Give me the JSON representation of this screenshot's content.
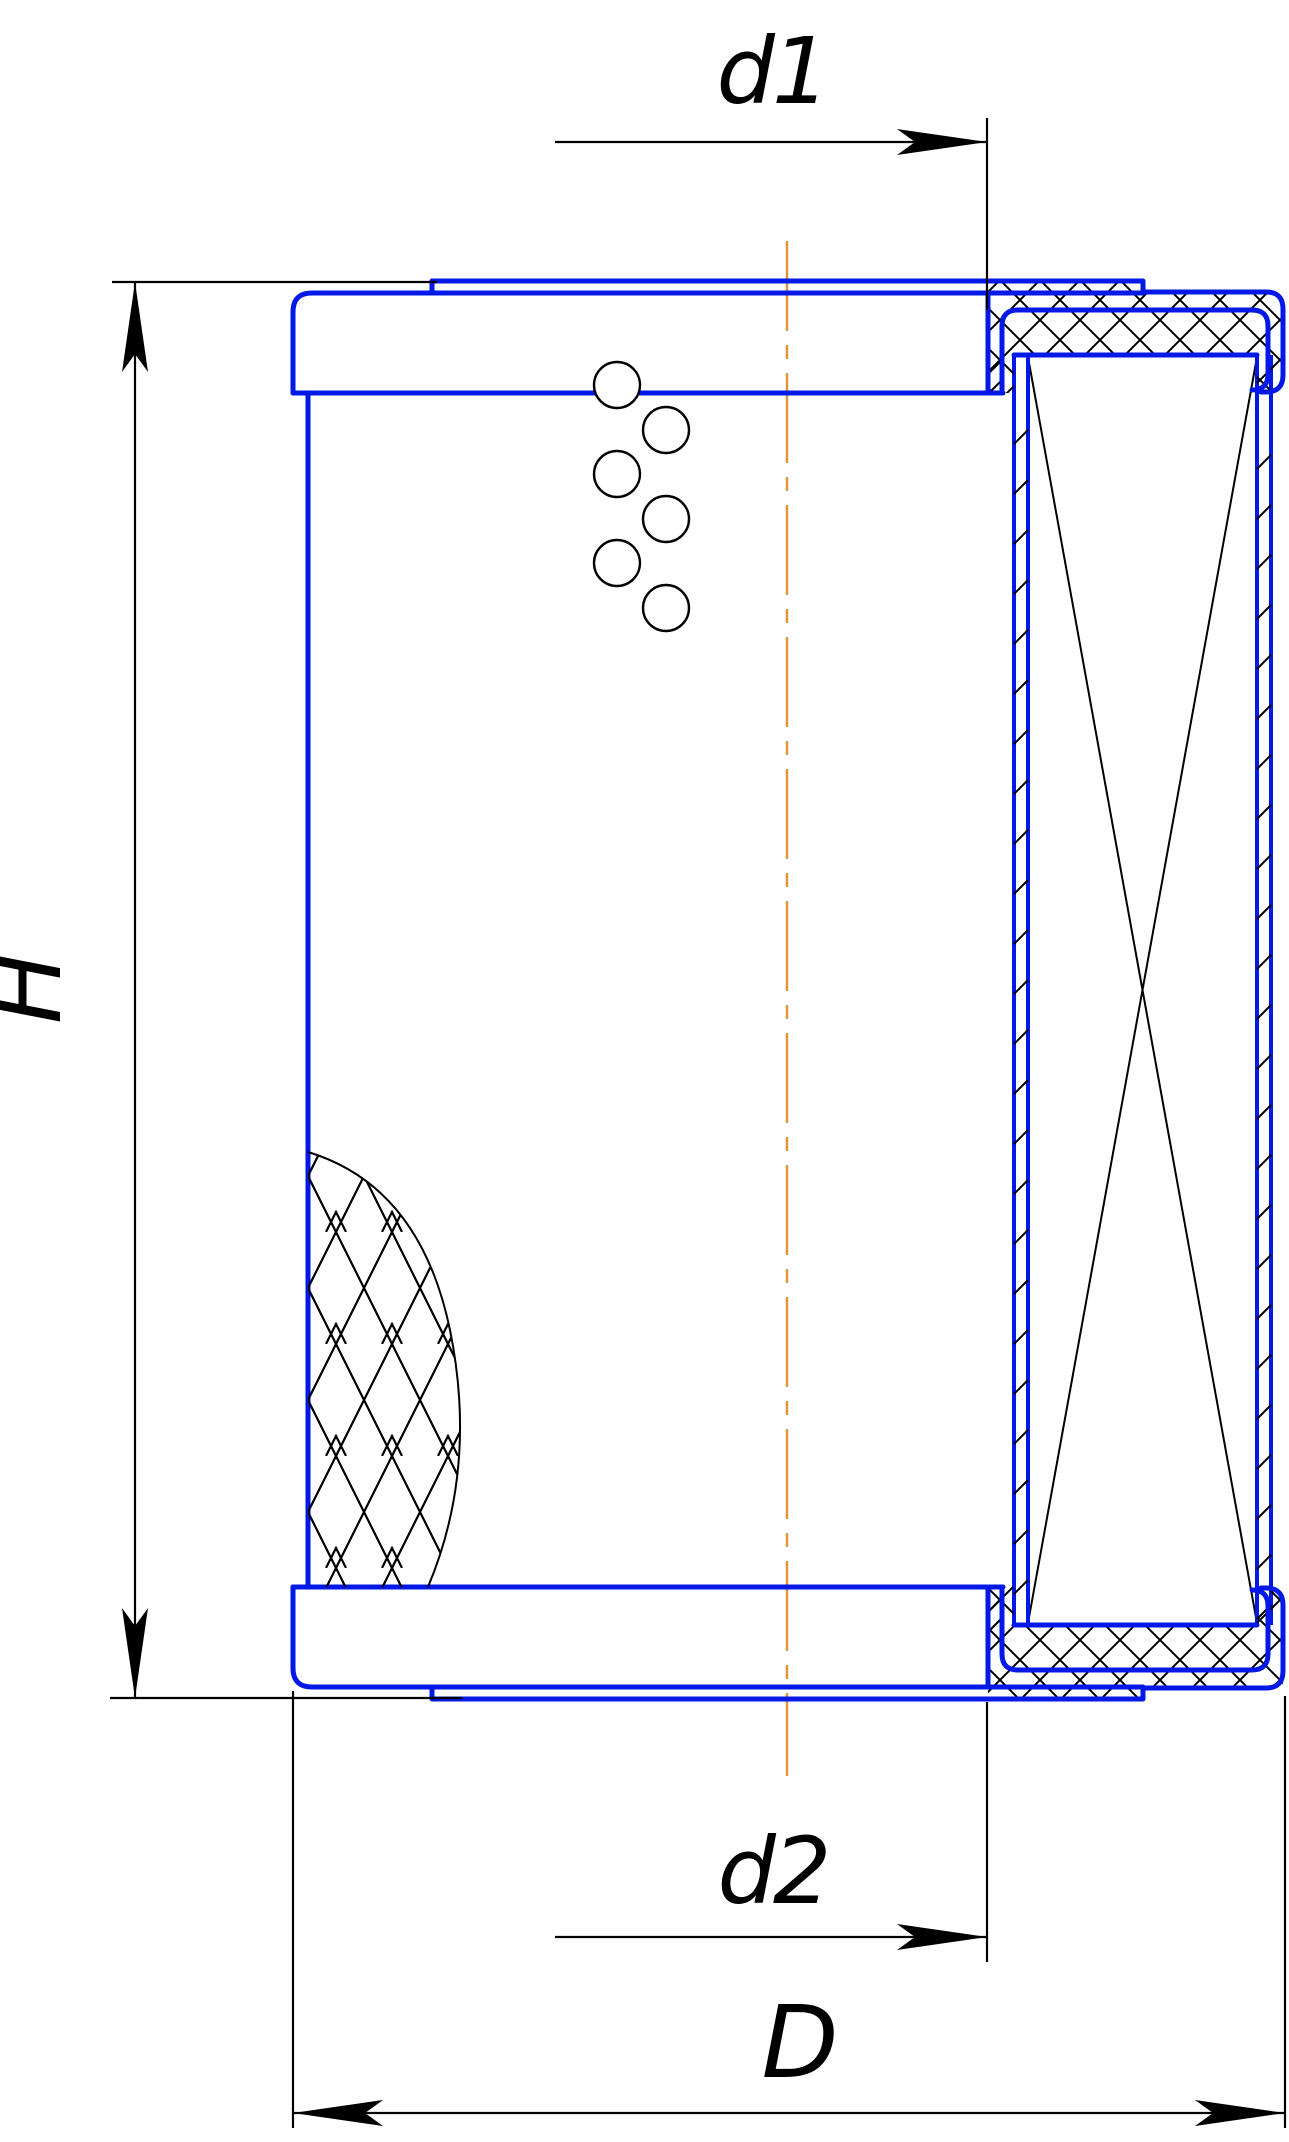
{
  "page": {
    "background": "#ffffff"
  },
  "colors": {
    "line-blue": "#0019e6",
    "centerline-orange": "#e0953c",
    "dimension-black": "#000000",
    "page-bg": "#ffffff"
  },
  "dimensions": [
    {
      "id": "d1",
      "label": "d1"
    },
    {
      "id": "H",
      "label": "H"
    },
    {
      "id": "d2",
      "label": "d2"
    },
    {
      "id": "D",
      "label": "D"
    }
  ]
}
